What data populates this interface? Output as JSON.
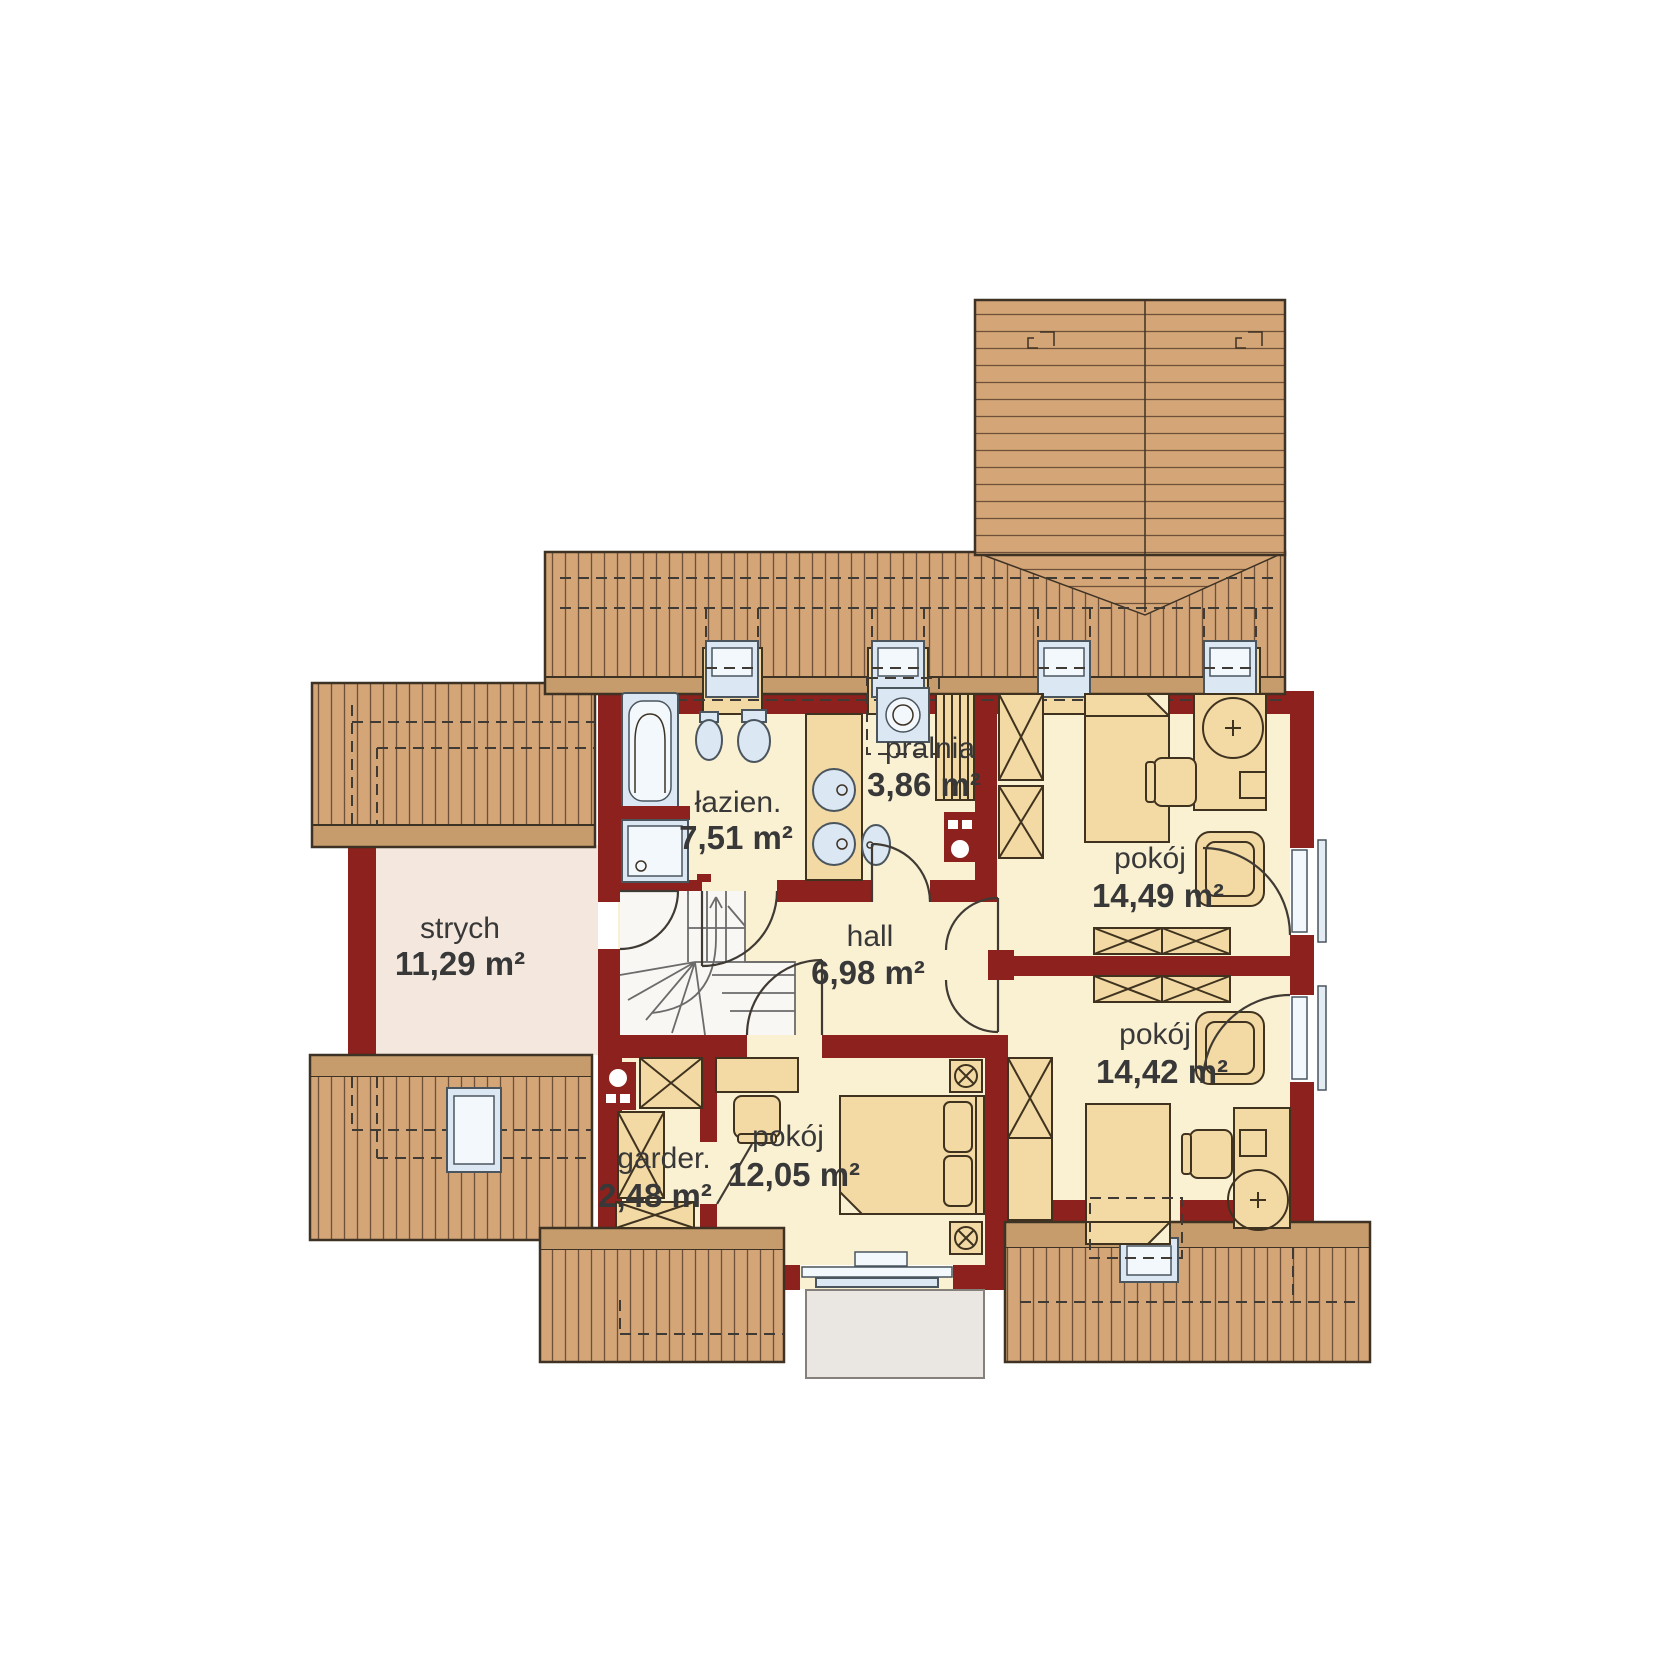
{
  "plan": {
    "type": "floor-plan",
    "language": "pl",
    "rooms": [
      {
        "id": "strych",
        "name": "strych",
        "area": "11,29 m²"
      },
      {
        "id": "lazienka",
        "name": "łazien.",
        "area": "7,51 m²"
      },
      {
        "id": "pralnia",
        "name": "pralnia",
        "area": "3,86 m²"
      },
      {
        "id": "hall",
        "name": "hall",
        "area": "6,98 m²"
      },
      {
        "id": "pokoj-1",
        "name": "pokój",
        "area": "14,49 m²"
      },
      {
        "id": "pokoj-2",
        "name": "pokój",
        "area": "14,42 m²"
      },
      {
        "id": "garderoba",
        "name": "garder.",
        "area": "2,48 m²"
      },
      {
        "id": "pokoj-3",
        "name": "pokój",
        "area": "12,05 m²"
      }
    ]
  },
  "colors": {
    "roof": "#d3a577",
    "roofline": "#6e5138",
    "eave": "#c79c6c",
    "outline": "#3e3225",
    "wall": "#8d211d",
    "floor": "#FAF0D2",
    "floorStrych": "#F4E8DE",
    "furn": "#F3D9A3",
    "furnstroke": "#3f3320",
    "fix": "#dbe7f2",
    "fixin": "#f3f8fc",
    "fixstroke": "#4a555e",
    "stair": "#f9f7f3",
    "balcony": "#eae7e2",
    "rail": "#e3ebf3",
    "dash": "#3f3a33",
    "doorline": "#3f3a33",
    "text": "#383838"
  }
}
